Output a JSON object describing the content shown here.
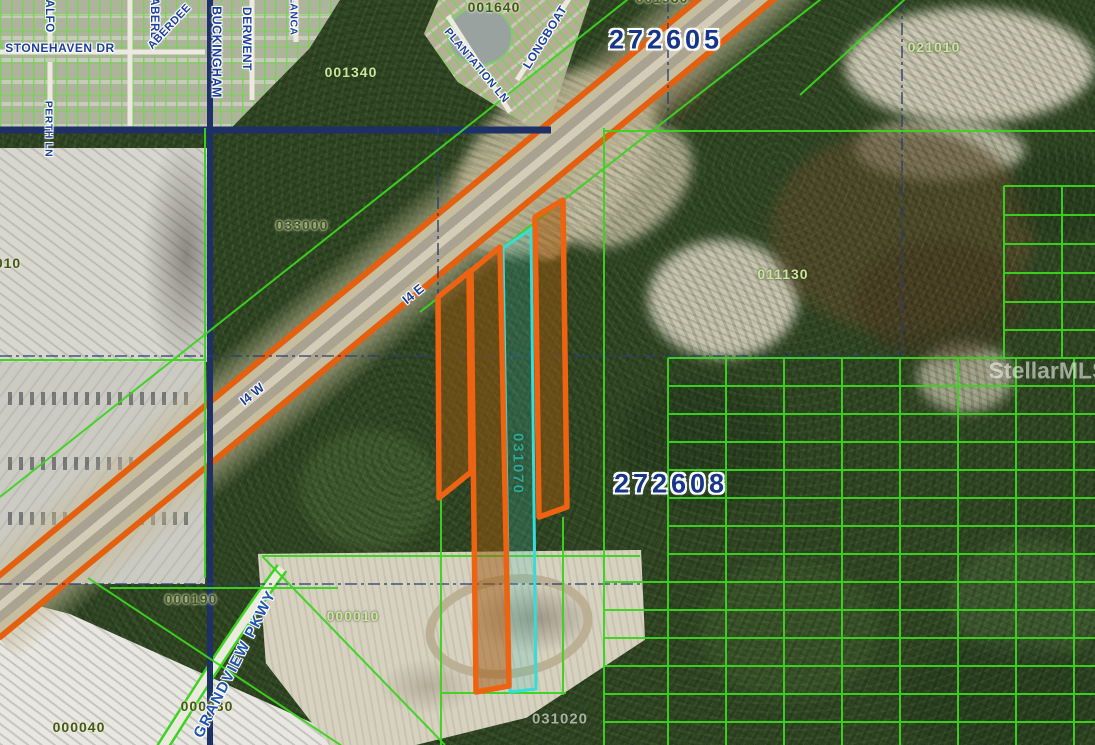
{
  "map": {
    "watermark": "StellarMLS",
    "sections": {
      "s605": "272605",
      "s608": "272608"
    },
    "parcels": {
      "p001930": "001930",
      "p001640": "001640",
      "p001340": "001340",
      "p021010": "021010",
      "p033000": "033000",
      "p011130": "011130",
      "p000190": "000190",
      "p000010": "000010",
      "p000030": "000030",
      "p000040": "000040",
      "p031070": "031070",
      "p031020": "031020",
      "p010": "010"
    },
    "streets": {
      "stonehaven": "STONEHAVEN DR",
      "alford": "ALFO",
      "aberdeen_v": "ABERD",
      "aberdeen_d": "ABERDEE",
      "buckingham": "BUCKINGHAM",
      "derwent": "DERWENT",
      "lancaster": "LANCA",
      "perth": "PERTH LN",
      "plantation": "PLANTATION LN",
      "longboat": "LONGBOAT",
      "grandview": "GRANDVIEW PKWY"
    },
    "highway": {
      "east_label": "I4 E",
      "west_label": "I4 W"
    },
    "colors": {
      "selection_orange": "#ee6312",
      "selection_cyan": "#35dcd8",
      "parcel_line_green": "#3bd41f",
      "label_navy": "#1c3f9e",
      "label_pale_green": "#c9e79b",
      "label_olive": "#45581a",
      "label_teal": "#2fa893",
      "watermark_white": "#ffffff"
    }
  }
}
